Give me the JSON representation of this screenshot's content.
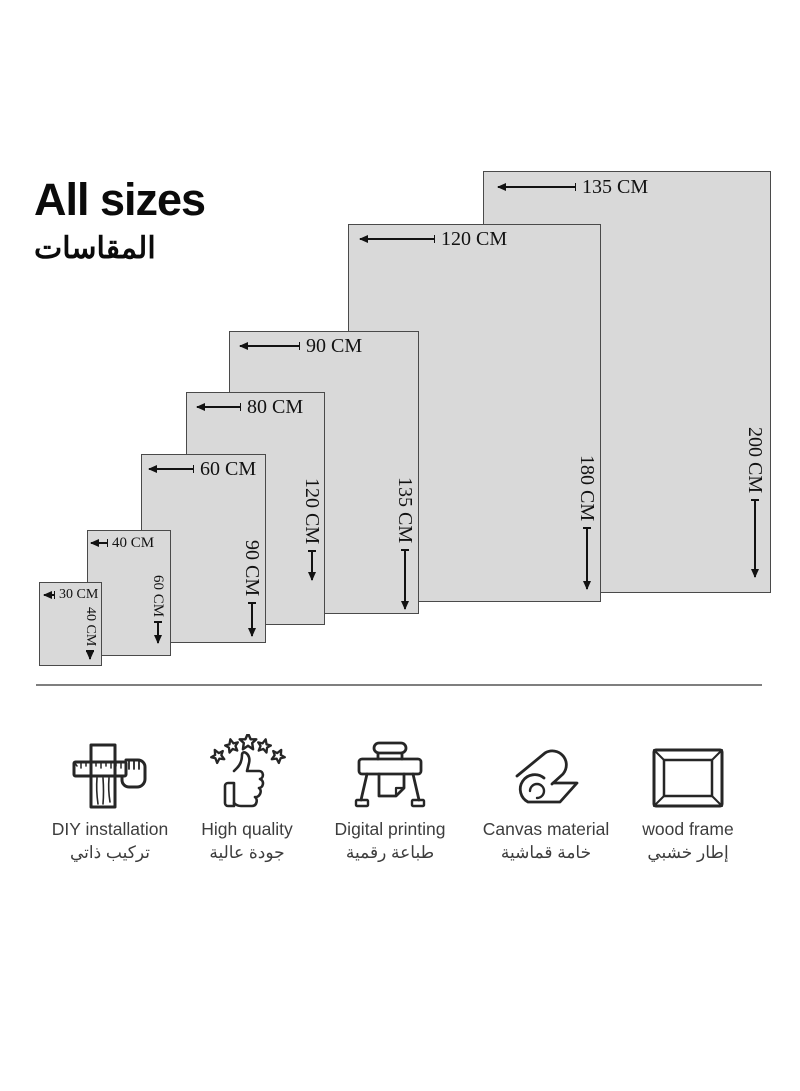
{
  "title": {
    "en": "All sizes",
    "ar": "المقاسات"
  },
  "sizes": [
    {
      "width_label": "135 CM",
      "height_label": "200 CM"
    },
    {
      "width_label": "120 CM",
      "height_label": "180 CM"
    },
    {
      "width_label": "90 CM",
      "height_label": "135 CM"
    },
    {
      "width_label": "80 CM",
      "height_label": "120 CM"
    },
    {
      "width_label": "60 CM",
      "height_label": "90 CM"
    },
    {
      "width_label": "40 CM",
      "height_label": "60 CM"
    },
    {
      "width_label": "30 CM",
      "height_label": "40 CM"
    }
  ],
  "features": [
    {
      "icon": "measuring-tape-plank-icon",
      "label_en": "DIY installation",
      "label_ar": "تركيب ذاتي"
    },
    {
      "icon": "thumbs-up-stars-icon",
      "label_en": "High quality",
      "label_ar": "جودة عالية"
    },
    {
      "icon": "plotter-printer-icon",
      "label_en": "Digital printing",
      "label_ar": "طباعة رقمية"
    },
    {
      "icon": "canvas-roll-icon",
      "label_en": "Canvas material",
      "label_ar": "خامة قماشية"
    },
    {
      "icon": "picture-frame-icon",
      "label_en": "wood frame",
      "label_ar": "إطار خشبي"
    }
  ],
  "colors": {
    "background": "#ffffff",
    "rect_fill": "#d9d9d9",
    "rect_border": "#4a4a4a",
    "dimension_text": "#121212",
    "divider": "#7f7f7f",
    "feature_text": "#3d3d3d",
    "title_text": "#0b0b0b"
  }
}
